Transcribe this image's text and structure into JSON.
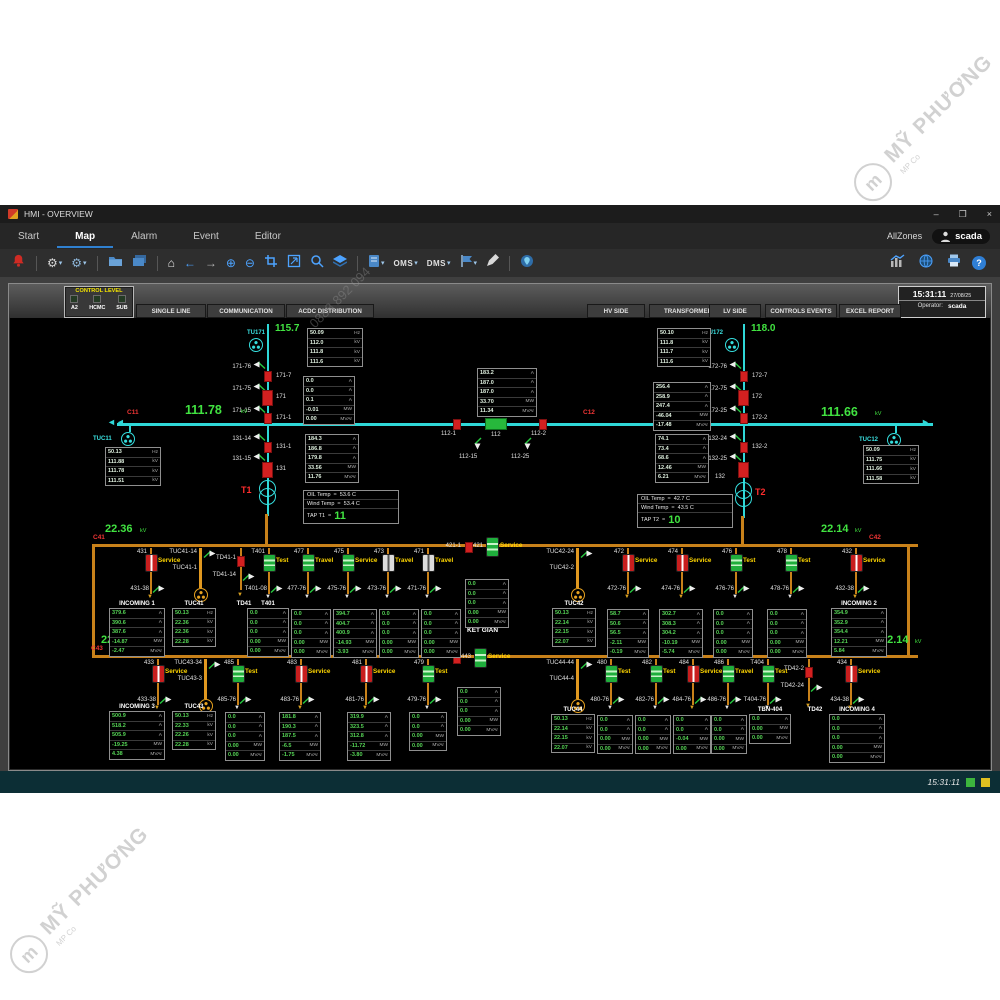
{
  "watermark": {
    "text": "MỸ PHƯƠNG",
    "logo": "m",
    "sub": "MP Co",
    "phone": "0888 892 094"
  },
  "titlebar": {
    "title": "HMI - OVERVIEW",
    "min": "–",
    "max": "❐",
    "close": "×"
  },
  "menubar": {
    "items": [
      {
        "label": "Start"
      },
      {
        "label": "Map",
        "active": true
      },
      {
        "label": "Alarm"
      },
      {
        "label": "Event"
      },
      {
        "label": "Editor"
      }
    ],
    "zone": "AllZones",
    "user": "scada"
  },
  "toolbar": {
    "oms": "OMS",
    "dms": "DMS"
  },
  "header": {
    "control_level": {
      "title": "CONTROL LEVEL",
      "items": [
        "A2",
        "HCMC",
        "SUB"
      ]
    },
    "tabs_left": [
      "SINGLE LINE",
      "COMMUNICATION",
      "ACDC DISTRIBUTION"
    ],
    "tabs_right": [
      "HV SIDE",
      "TRANSFORMER",
      "LV SIDE",
      "CONTROLS EVENTS",
      "EXCEL REPORT"
    ],
    "clock": {
      "time": "15:31:11",
      "date": "27/08/25",
      "operator_label": "Operator:",
      "operator": "scada"
    }
  },
  "hv": {
    "tu171": {
      "name": "TU171",
      "voltage": "115.7",
      "switches": [
        "171-76",
        "171-75",
        "171-15"
      ],
      "breakers": [
        "171-7",
        "171",
        "171-1"
      ]
    },
    "tu172": {
      "name": "TU172",
      "voltage": "118.0",
      "switches": [
        "172-76",
        "172-75",
        "172-25"
      ],
      "breakers": [
        "172-7",
        "172",
        "172-2"
      ]
    },
    "bus_left": {
      "id": "C11",
      "kv": "111.78",
      "unit": "kV",
      "arrester": "TUC11"
    },
    "bus_right": {
      "id": "C12",
      "kv": "111.66",
      "unit": "kV",
      "arrester": "TUC12"
    },
    "coupler": {
      "left_disc": "112-1",
      "breaker": "112",
      "right_disc": "112-2",
      "earth_left": "112-15",
      "earth_right": "112-25"
    },
    "t1": {
      "name": "T1",
      "switches": [
        "131-14",
        "131-15"
      ],
      "disc": "131-1",
      "breaker": "131"
    },
    "t2": {
      "name": "T2",
      "switches": [
        "132-24",
        "132-25"
      ],
      "disc": "132-2",
      "breaker": "132"
    }
  },
  "temps": {
    "t1": {
      "rows": [
        [
          "OIL Temp",
          "=",
          "53.6 C"
        ],
        [
          "Wind Temp",
          "=",
          "53.4 C"
        ]
      ],
      "tap_label": "TAP T1",
      "tap_eq": "=",
      "tap": "11"
    },
    "t2": {
      "rows": [
        [
          "OIL Temp",
          "=",
          "42.7 C"
        ],
        [
          "Wind Temp",
          "=",
          "43.5 C"
        ]
      ],
      "tap_label": "TAP T2",
      "tap_eq": "=",
      "tap": "10"
    }
  },
  "mv": {
    "ketgian": "KẾT GIÀN",
    "row1": {
      "bus_left": {
        "id": "C41",
        "kv": "22.36",
        "unit": "kV"
      },
      "bus_right": {
        "id": "C42",
        "kv": "22.14",
        "unit": "kV"
      },
      "feeders": [
        {
          "kind": "brk",
          "id": "431",
          "state": "Service",
          "color": "red",
          "sub": "431-38"
        },
        {
          "kind": "arr",
          "top": "TUC41-14",
          "id": "TUC41-1"
        },
        {
          "kind": "td",
          "id": "TD41-1",
          "sub": "TD41-14"
        },
        {
          "kind": "brk",
          "id": "T401",
          "state": "Test",
          "color": "green",
          "sub": "T401-08"
        },
        {
          "kind": "brk",
          "id": "477",
          "state": "Travel",
          "color": "green",
          "sub": "477-76"
        },
        {
          "kind": "brk",
          "id": "475",
          "state": "Service",
          "color": "green",
          "sub": "475-76"
        },
        {
          "kind": "brk",
          "id": "473",
          "state": "Travel",
          "color": "white",
          "sub": "473-76"
        },
        {
          "kind": "brk",
          "id": "471",
          "state": "Travel",
          "color": "white",
          "sub": "471-76"
        },
        {
          "kind": "tie",
          "disc": "421-1",
          "id": "421",
          "state": "Service"
        },
        {
          "kind": "arr",
          "top": "TUC42-24",
          "id": "TUC42-2"
        },
        {
          "kind": "brk",
          "id": "472",
          "state": "Service",
          "color": "red",
          "sub": "472-76"
        },
        {
          "kind": "brk",
          "id": "474",
          "state": "Service",
          "color": "red",
          "sub": "474-76"
        },
        {
          "kind": "brk",
          "id": "476",
          "state": "Test",
          "color": "green",
          "sub": "476-76"
        },
        {
          "kind": "brk",
          "id": "478",
          "state": "Test",
          "color": "green",
          "sub": "478-76"
        },
        {
          "kind": "brk",
          "id": "432",
          "state": "Service",
          "color": "red",
          "sub": "432-38"
        }
      ]
    },
    "row2": {
      "bus_left": {
        "id": "C43",
        "kv": "22.28",
        "unit": "kV"
      },
      "bus_right": {
        "id": "C44",
        "kv": "22.14",
        "unit": "kV"
      },
      "feeders": [
        {
          "kind": "brk",
          "id": "433",
          "state": "Service",
          "color": "red",
          "sub": "433-38"
        },
        {
          "kind": "arr",
          "top": "TUC43-34",
          "id": "TUC43-3"
        },
        {
          "kind": "brk",
          "id": "485",
          "state": "Test",
          "color": "green",
          "sub": "485-76"
        },
        {
          "kind": "brk",
          "id": "483",
          "state": "Service",
          "color": "red",
          "sub": "483-76"
        },
        {
          "kind": "brk",
          "id": "481",
          "state": "Service",
          "color": "red",
          "sub": "481-76"
        },
        {
          "kind": "brk",
          "id": "479",
          "state": "Test",
          "color": "green",
          "sub": "479-76"
        },
        {
          "kind": "tie",
          "disc": "443-1",
          "id": "443",
          "state": "Service"
        },
        {
          "kind": "arr",
          "top": "TUC44-44",
          "id": "TUC44-4"
        },
        {
          "kind": "brk",
          "id": "480",
          "state": "Test",
          "color": "green",
          "sub": "480-76"
        },
        {
          "kind": "brk",
          "id": "482",
          "state": "Test",
          "color": "green",
          "sub": "482-76"
        },
        {
          "kind": "brk",
          "id": "484",
          "state": "Service",
          "color": "red",
          "sub": "484-76"
        },
        {
          "kind": "brk",
          "id": "486",
          "state": "Travel",
          "color": "green",
          "sub": "486-76"
        },
        {
          "kind": "brk",
          "id": "T404",
          "state": "Test",
          "color": "green",
          "sub": "T404-76"
        },
        {
          "kind": "td",
          "id": "TD42-2",
          "sub": "TD42-24"
        },
        {
          "kind": "brk",
          "id": "434",
          "state": "Service",
          "color": "red",
          "sub": "434-38"
        }
      ]
    }
  },
  "meters": {
    "tu171_v": {
      "rows": [
        [
          "50.09",
          "Hz"
        ],
        [
          "112.0",
          "kV"
        ],
        [
          "111.8",
          "kV"
        ],
        [
          "111.6",
          "kV"
        ]
      ]
    },
    "tu171_i": {
      "rows": [
        [
          "0.0",
          "A"
        ],
        [
          "0.0",
          "A"
        ],
        [
          "0.1",
          "A"
        ],
        [
          "-0.01",
          "MW"
        ],
        [
          "0.00",
          "MVAr"
        ]
      ]
    },
    "tu172_v": {
      "rows": [
        [
          "50.10",
          "Hz"
        ],
        [
          "111.8",
          "kV"
        ],
        [
          "111.7",
          "kV"
        ],
        [
          "111.6",
          "kV"
        ]
      ]
    },
    "tu172_i": {
      "rows": [
        [
          "256.4",
          "A"
        ],
        [
          "258.9",
          "A"
        ],
        [
          "247.4",
          "A"
        ],
        [
          "-46.04",
          "MW"
        ],
        [
          "-17.48",
          "MVAr"
        ]
      ]
    },
    "tuc11": {
      "rows": [
        [
          "50.13",
          "Hz"
        ],
        [
          "111.88",
          "kV"
        ],
        [
          "111.78",
          "kV"
        ],
        [
          "111.51",
          "kV"
        ]
      ]
    },
    "tuc12": {
      "rows": [
        [
          "50.09",
          "Hz"
        ],
        [
          "111.75",
          "kV"
        ],
        [
          "111.66",
          "kV"
        ],
        [
          "111.58",
          "kV"
        ]
      ]
    },
    "c112": {
      "rows": [
        [
          "183.2",
          "A"
        ],
        [
          "187.0",
          "A"
        ],
        [
          "187.0",
          "A"
        ],
        [
          "33.70",
          "MW"
        ],
        [
          "11.34",
          "MVAr"
        ]
      ]
    },
    "t1m": {
      "rows": [
        [
          "184.3",
          "A"
        ],
        [
          "186.8",
          "A"
        ],
        [
          "179.8",
          "A"
        ],
        [
          "33.56",
          "MW"
        ],
        [
          "11.76",
          "MVAr"
        ]
      ]
    },
    "t2m": {
      "rows": [
        [
          "74.1",
          "A"
        ],
        [
          "73.4",
          "A"
        ],
        [
          "68.6",
          "A"
        ],
        [
          "12.46",
          "MW"
        ],
        [
          "6.21",
          "MVAr"
        ]
      ]
    },
    "inc1": {
      "title": "INCOMING 1",
      "rows": [
        [
          "379.6",
          "A"
        ],
        [
          "390.6",
          "A"
        ],
        [
          "387.6",
          "A"
        ],
        [
          "-14.87",
          "MW"
        ],
        [
          "-2.47",
          "MVAr"
        ]
      ]
    },
    "tuc41": {
      "title": "TUC41",
      "rows": [
        [
          "50.13",
          "Hz"
        ],
        [
          "22.36",
          "kV"
        ],
        [
          "22.36",
          "kV"
        ],
        [
          "22.28",
          "kV"
        ]
      ]
    },
    "td41": {
      "title": "TD41",
      "rows": []
    },
    "t401": {
      "title": "T401",
      "rows": [
        [
          "0.0",
          "A"
        ],
        [
          "0.0",
          "A"
        ],
        [
          "0.0",
          "A"
        ],
        [
          "0.00",
          "MW"
        ],
        [
          "0.00",
          "MVAr"
        ]
      ]
    },
    "f477": {
      "rows": [
        [
          "0.0",
          "A"
        ],
        [
          "0.0",
          "A"
        ],
        [
          "0.0",
          "A"
        ],
        [
          "0.00",
          "MW"
        ],
        [
          "0.00",
          "MVAr"
        ]
      ]
    },
    "f475": {
      "rows": [
        [
          "394.7",
          "A"
        ],
        [
          "404.7",
          "A"
        ],
        [
          "400.9",
          "A"
        ],
        [
          "-14.93",
          "MW"
        ],
        [
          "-3.93",
          "MVAr"
        ]
      ]
    },
    "f473": {
      "rows": [
        [
          "0.0",
          "A"
        ],
        [
          "0.0",
          "A"
        ],
        [
          "0.0",
          "A"
        ],
        [
          "0.00",
          "MW"
        ],
        [
          "0.00",
          "MVAr"
        ]
      ]
    },
    "f471": {
      "rows": [
        [
          "0.0",
          "A"
        ],
        [
          "0.0",
          "A"
        ],
        [
          "0.0",
          "A"
        ],
        [
          "0.00",
          "MW"
        ],
        [
          "0.00",
          "MVAr"
        ]
      ]
    },
    "tie421": {
      "rows": [
        [
          "0.0",
          "A"
        ],
        [
          "0.0",
          "A"
        ],
        [
          "0.0",
          "A"
        ],
        [
          "0.00",
          "MW"
        ],
        [
          "0.00",
          "MVAr"
        ]
      ]
    },
    "tuc42": {
      "title": "TUC42",
      "rows": [
        [
          "50.13",
          "Hz"
        ],
        [
          "22.14",
          "kV"
        ],
        [
          "22.15",
          "kV"
        ],
        [
          "22.07",
          "kV"
        ]
      ]
    },
    "f472": {
      "rows": [
        [
          "58.7",
          "A"
        ],
        [
          "50.6",
          "A"
        ],
        [
          "56.5",
          "A"
        ],
        [
          "-2.11",
          "MW"
        ],
        [
          "-0.19",
          "MVAr"
        ]
      ]
    },
    "f474": {
      "rows": [
        [
          "302.7",
          "A"
        ],
        [
          "308.3",
          "A"
        ],
        [
          "304.2",
          "A"
        ],
        [
          "-10.19",
          "MW"
        ],
        [
          "-5.74",
          "MVAr"
        ]
      ]
    },
    "f476": {
      "rows": [
        [
          "0.0",
          "A"
        ],
        [
          "0.0",
          "A"
        ],
        [
          "0.0",
          "A"
        ],
        [
          "0.00",
          "MW"
        ],
        [
          "0.00",
          "MVAr"
        ]
      ]
    },
    "f478": {
      "rows": [
        [
          "0.0",
          "A"
        ],
        [
          "0.0",
          "A"
        ],
        [
          "0.0",
          "A"
        ],
        [
          "0.00",
          "MW"
        ],
        [
          "0.00",
          "MVAr"
        ]
      ]
    },
    "inc2": {
      "title": "INCOMING 2",
      "rows": [
        [
          "354.9",
          "A"
        ],
        [
          "352.9",
          "A"
        ],
        [
          "354.4",
          "A"
        ],
        [
          "12.21",
          "MW"
        ],
        [
          "5.84",
          "MVAr"
        ]
      ]
    },
    "inc3": {
      "title": "INCOMING 3",
      "rows": [
        [
          "500.9",
          "A"
        ],
        [
          "518.2",
          "A"
        ],
        [
          "505.9",
          "A"
        ],
        [
          "-19.25",
          "MW"
        ],
        [
          "4.38",
          "MVAr"
        ]
      ]
    },
    "tuc43": {
      "title": "TUC43",
      "rows": [
        [
          "50.13",
          "Hz"
        ],
        [
          "22.33",
          "kV"
        ],
        [
          "22.26",
          "kV"
        ],
        [
          "22.28",
          "kV"
        ]
      ]
    },
    "f485": {
      "rows": [
        [
          "0.0",
          "A"
        ],
        [
          "0.0",
          "A"
        ],
        [
          "0.0",
          "A"
        ],
        [
          "0.00",
          "MW"
        ],
        [
          "0.00",
          "MVAr"
        ]
      ]
    },
    "f483": {
      "rows": [
        [
          "181.8",
          "A"
        ],
        [
          "190.3",
          "A"
        ],
        [
          "187.5",
          "A"
        ],
        [
          "-6.5",
          "MW"
        ],
        [
          "-1.75",
          "MVAr"
        ]
      ]
    },
    "f481": {
      "rows": [
        [
          "319.9",
          "A"
        ],
        [
          "323.5",
          "A"
        ],
        [
          "312.8",
          "A"
        ],
        [
          "-11.72",
          "MW"
        ],
        [
          "-3.80",
          "MVAr"
        ]
      ]
    },
    "f479": {
      "rows": [
        [
          "0.0",
          "A"
        ],
        [
          "0.0",
          "A"
        ],
        [
          "0.00",
          "MW"
        ],
        [
          "0.00",
          "MVAr"
        ]
      ]
    },
    "tie443": {
      "rows": [
        [
          "0.0",
          "A"
        ],
        [
          "0.0",
          "A"
        ],
        [
          "0.0",
          "A"
        ],
        [
          "0.00",
          "MW"
        ],
        [
          "0.00",
          "MVAr"
        ]
      ]
    },
    "tuc44": {
      "title": "TUC44",
      "rows": [
        [
          "50.13",
          "Hz"
        ],
        [
          "22.14",
          "kV"
        ],
        [
          "22.15",
          "kV"
        ],
        [
          "22.07",
          "kV"
        ]
      ]
    },
    "f480": {
      "rows": [
        [
          "0.0",
          "A"
        ],
        [
          "0.0",
          "A"
        ],
        [
          "0.00",
          "MW"
        ],
        [
          "0.00",
          "MVAr"
        ]
      ]
    },
    "f482": {
      "rows": [
        [
          "0.0",
          "A"
        ],
        [
          "0.0",
          "A"
        ],
        [
          "0.00",
          "MW"
        ],
        [
          "0.00",
          "MVAr"
        ]
      ]
    },
    "f484": {
      "rows": [
        [
          "0.0",
          "A"
        ],
        [
          "0.0",
          "A"
        ],
        [
          "-0.04",
          "MW"
        ],
        [
          "0.00",
          "MVAr"
        ]
      ]
    },
    "f486": {
      "rows": [
        [
          "0.0",
          "A"
        ],
        [
          "0.0",
          "A"
        ],
        [
          "0.00",
          "MW"
        ],
        [
          "0.00",
          "MVAr"
        ]
      ]
    },
    "tbn404": {
      "title": "TBN-404",
      "rows": [
        [
          "0.0",
          "A"
        ],
        [
          "0.00",
          "MW"
        ],
        [
          "0.00",
          "MVAr"
        ]
      ]
    },
    "td42": {
      "title": "TD42",
      "rows": []
    },
    "inc4": {
      "title": "INCOMING 4",
      "rows": [
        [
          "0.0",
          "A"
        ],
        [
          "0.0",
          "A"
        ],
        [
          "0.0",
          "A"
        ],
        [
          "0.00",
          "MW"
        ],
        [
          "0.00",
          "MVAr"
        ]
      ]
    }
  },
  "statusbar": {
    "time": "15:31:11"
  }
}
